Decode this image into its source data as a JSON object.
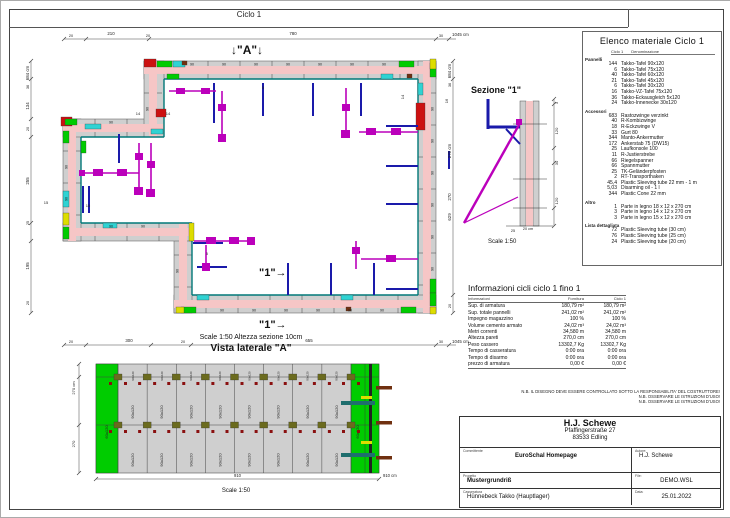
{
  "sheet": {
    "title": "Ciclo 1"
  },
  "plan": {
    "marker_a": "↓\"A\"↓",
    "marker_1a": "\"1\"→",
    "marker_1b": "\"1\"→",
    "panel_label": "90",
    "dims_top": [
      {
        "t": "20",
        "x": 70,
        "y": 36,
        "s": 3.8
      },
      {
        "t": "210",
        "x": 110,
        "y": 34,
        "s": 4.4
      },
      {
        "t": "20",
        "x": 147,
        "y": 36,
        "s": 3.8
      },
      {
        "t": "780",
        "x": 292,
        "y": 34,
        "s": 4.4
      },
      {
        "t": "30",
        "x": 440,
        "y": 36,
        "s": 3.8
      },
      {
        "t": "1045 cm",
        "x": 451,
        "y": 35,
        "s": 4.4,
        "a": "start"
      }
    ],
    "dims_bottom": [
      {
        "t": "20",
        "x": 70,
        "y": 342,
        "s": 3.8
      },
      {
        "t": "300",
        "x": 128,
        "y": 341,
        "s": 4.4
      },
      {
        "t": "20",
        "x": 182,
        "y": 342,
        "s": 3.8
      },
      {
        "t": "655",
        "x": 308,
        "y": 341,
        "s": 4.4
      },
      {
        "t": "30",
        "x": 440,
        "y": 342,
        "s": 3.8
      },
      {
        "t": "1045 cm",
        "x": 451,
        "y": 342,
        "s": 4.4,
        "a": "start"
      }
    ],
    "dims_left": [
      {
        "t": "684 cm",
        "y": 72,
        "s": 4.4
      },
      {
        "t": "36",
        "y": 86,
        "s": 3.8
      },
      {
        "t": "134",
        "y": 105,
        "s": 4.4
      },
      {
        "t": "20",
        "y": 128,
        "s": 3.8
      },
      {
        "t": "255",
        "y": 180,
        "s": 4.4
      },
      {
        "t": "25",
        "y": 222,
        "s": 3.8
      },
      {
        "t": "195",
        "y": 265,
        "s": 4.4
      },
      {
        "t": "20",
        "y": 302,
        "s": 3.8
      }
    ],
    "dims_right": [
      {
        "t": "684 cm",
        "y": 70,
        "s": 4.4
      },
      {
        "t": "36",
        "y": 84,
        "s": 3.8
      },
      {
        "t": "270 cm",
        "y": 150,
        "s": 4.4
      },
      {
        "t": "270",
        "y": 196,
        "s": 4.4
      },
      {
        "t": "629",
        "y": 216,
        "s": 4.4
      },
      {
        "t": "20",
        "y": 305,
        "s": 3.8
      }
    ],
    "inner_labels": [
      {
        "t": "14",
        "x": 137,
        "y": 114,
        "s": 4
      },
      {
        "t": "14",
        "x": 167,
        "y": 114,
        "s": 4
      },
      {
        "t": "14",
        "x": 403,
        "y": 96,
        "s": 4,
        "rot": 1
      },
      {
        "t": "16",
        "x": 447,
        "y": 100,
        "s": 4,
        "rot": 1
      },
      {
        "t": "15",
        "x": 45,
        "y": 203,
        "s": 4
      },
      {
        "t": "15",
        "x": 87,
        "y": 206,
        "s": 4
      },
      {
        "t": "5",
        "x": 206,
        "y": 254,
        "s": 3.6
      },
      {
        "t": "5",
        "x": 262,
        "y": 88,
        "s": 3.6
      }
    ]
  },
  "sezione": {
    "title": "Sezione \"1\"",
    "scale": "Scale 1:50",
    "dims": [
      {
        "t": "3",
        "y": 102
      },
      {
        "t": "120",
        "y": 130
      },
      {
        "t": "30",
        "y": 162
      },
      {
        "t": "120",
        "y": 200
      }
    ],
    "thickness": [
      {
        "t": "25",
        "x": 512,
        "y": 231
      },
      {
        "t": "20 cm",
        "x": 527,
        "y": 229
      }
    ]
  },
  "materials": {
    "title": "Elenco materiale  Ciclo 1",
    "col_qty": "Ciclo 1",
    "col_name": "Denominazione",
    "sections": [
      {
        "label": "Pannelli",
        "items": [
          [
            "144",
            "Takko-Tafel 90x120"
          ],
          [
            "6",
            "Takko-Tafel 75x120"
          ],
          [
            "40",
            "Takko-Tafel 60x120"
          ],
          [
            "21",
            "Takko-Tafel 45x120"
          ],
          [
            "6",
            "Takko-Tafel 30x120"
          ],
          [
            "16",
            "Takko-VZ-Tafel 75x120"
          ],
          [
            "36",
            "Takko-Eckausgleich 5x120"
          ],
          [
            "24",
            "Takko-Innenecke 30x120"
          ]
        ]
      },
      {
        "label": "Accessori",
        "items": [
          [
            "683",
            "Rastozwinge verzinkt"
          ],
          [
            "40",
            "R-Kombizwinge"
          ],
          [
            "18",
            "R-Eckzwinge V"
          ],
          [
            "33",
            "Gurt 80"
          ],
          [
            "344",
            "Manto-Ankermutter"
          ],
          [
            "172",
            "Ankerstab  75 (DW15)"
          ],
          [
            "25",
            "Laufkonsole 100"
          ],
          [
            "11",
            "R-Justierstrebe"
          ],
          [
            "66",
            "Riegelspanner"
          ],
          [
            "66",
            "Spannmutter"
          ],
          [
            "25",
            "TK-Geländerpfosten"
          ],
          [
            "2",
            "RT-Transporthaken"
          ],
          [
            "45,4",
            "Plastic Sleeving tube 22 mm - 1 m"
          ],
          [
            "5,03",
            "Disarming oil - 1 l"
          ],
          [
            "344",
            "Plastic Cone 22 mm"
          ]
        ]
      },
      {
        "label": "Altro",
        "items": [
          [
            "1",
            "Parte in legno 18 x 12 x 270 cm"
          ],
          [
            "3",
            "Parte in legno 14 x 12 x 270 cm"
          ],
          [
            "3",
            "Parte in legno 15 x 12 x 270 cm"
          ]
        ]
      },
      {
        "label": "Lista dettagliata",
        "items": [
          [
            "72",
            "Plastic Sleeving tube  (30 cm)"
          ],
          [
            "76",
            "Plastic Sleeving tube  (25 cm)"
          ],
          [
            "24",
            "Plastic Sleeving tube  (20 cm)"
          ]
        ]
      }
    ]
  },
  "info": {
    "title": "Informazioni cicli  ciclo 1 fino 1",
    "col_label": "Informazioni",
    "col_fornitura": "Fornitura",
    "col_ciclo": "Ciclo 1",
    "rows": [
      [
        "Sup. di armatura",
        "180,79 m²",
        "180,79 m²"
      ],
      [
        "Sup. totale pannelli",
        "241,02 m²",
        "241,02 m²"
      ],
      [
        "Impegno magazzino",
        "100 %",
        "100 %"
      ],
      [
        "Volume cemento armato",
        "24,02 m³",
        "24,02 m³"
      ],
      [
        "Metri correnti",
        "34,580 m",
        "34,580 m"
      ],
      [
        "Altezza pareti",
        "270,0 cm",
        "270,0 cm"
      ],
      [
        "Peso cassero",
        "13302,7 Kg",
        "13302,7 Kg"
      ],
      [
        "Tempo di casseratura",
        "0:00 ora",
        "0:00 ora"
      ],
      [
        "Tempo di disarmo",
        "0:00 ora",
        "0:00 ora"
      ],
      [
        "prezzo di armatura",
        "0,00 €",
        "0,00 €"
      ]
    ]
  },
  "notes": [
    "N.B. IL DISEGNO DEVE ESSERE CONTROLLATO SOTTO LA RESPONSABILITA' DEL COSTRUTTORE!",
    "N.B. OSSERVARE LE ISTRUZIONI D'USO!",
    "N.B. OSSERVARE LE ISTRUZIONI D'USO!"
  ],
  "titleblock": {
    "company": "H.J. Schewe",
    "address1": "Pfaffingerstraße 27",
    "address2": "83533 Edling",
    "label_committente": "Committente",
    "committente": "EuroSchal Homepage",
    "label_autore": "Autore:",
    "autore": "H.J. Schewe",
    "label_progetto": "Progetto",
    "progetto": "Mustergrundriß",
    "label_file": "File:",
    "file": "DEMO.WSL",
    "label_casseratura": "Casseratura",
    "casseratura": "Hünnebeck Takko (Hauptlager)",
    "label_data": "Data:",
    "data": "25.01.2022"
  },
  "vista": {
    "scale_top": "Scale 1:50   Altezza sezione 10cm",
    "title": "Vista laterale \"A\"",
    "cell_label": "90x120",
    "green_left_label": "60x120",
    "green_right_labels": [
      "60x120",
      "90x120"
    ],
    "dim_left_total": "270 cm",
    "dim_left": "270",
    "dim_bottom": "910",
    "dim_bottom_total": "910 cm",
    "scale_bottom": "Scale 1:50"
  },
  "colors": {
    "wall_pink": "#f6c6c6",
    "panel_gray": "#cfcfcf",
    "green": "#00cc00",
    "cyan": "#2fd3d3",
    "red": "#cc1111",
    "navy": "#1a1aaa",
    "magenta": "#bb00bb",
    "yellow": "#dddd00",
    "teal_edge": "#007878"
  }
}
